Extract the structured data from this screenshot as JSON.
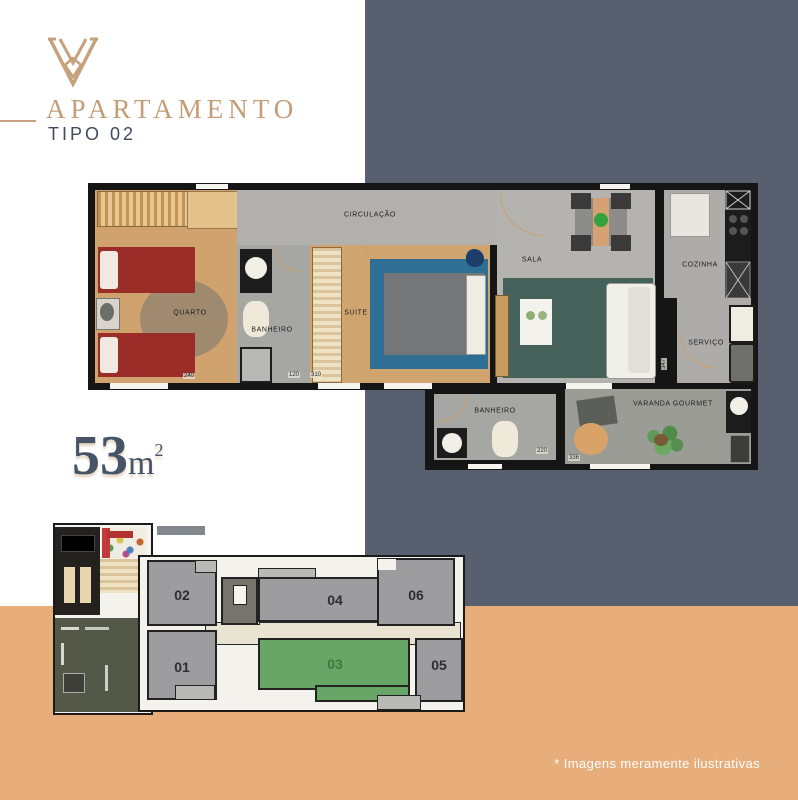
{
  "colors": {
    "navy": "#58606F",
    "orange": "#E7AE7B",
    "tan": "#C7A17B",
    "unit_gray": "#9D9DA0",
    "unit_green": "#68A667"
  },
  "header": {
    "title": "APARTAMENTO",
    "subtitle": "TIPO 02"
  },
  "area": {
    "value": "53",
    "unit": "m",
    "exponent": "2"
  },
  "floor_plan": {
    "rooms": {
      "circulacao": "CIRCULAÇÃO",
      "quarto": "QUARTO",
      "banheiro1": "BANHEIRO",
      "suite": "SUITE",
      "sala": "SALA",
      "cozinha": "COZINHA",
      "servico": "SERVIÇO",
      "banheiro2": "BANHEIRO",
      "varanda": "VARANDA GOURMET"
    },
    "dimensions": {
      "quarto_w": "240",
      "banheiro_w": "120",
      "suite_w": "310",
      "banheiro2_w": "220",
      "varanda_w": "336",
      "servico_h": "347"
    }
  },
  "key_plan": {
    "units": {
      "u01": "01",
      "u02": "02",
      "u03": "03",
      "u04": "04",
      "u05": "05",
      "u06": "06"
    }
  },
  "footer": {
    "disclaimer": "*  Imagens meramente ilustrativas"
  }
}
